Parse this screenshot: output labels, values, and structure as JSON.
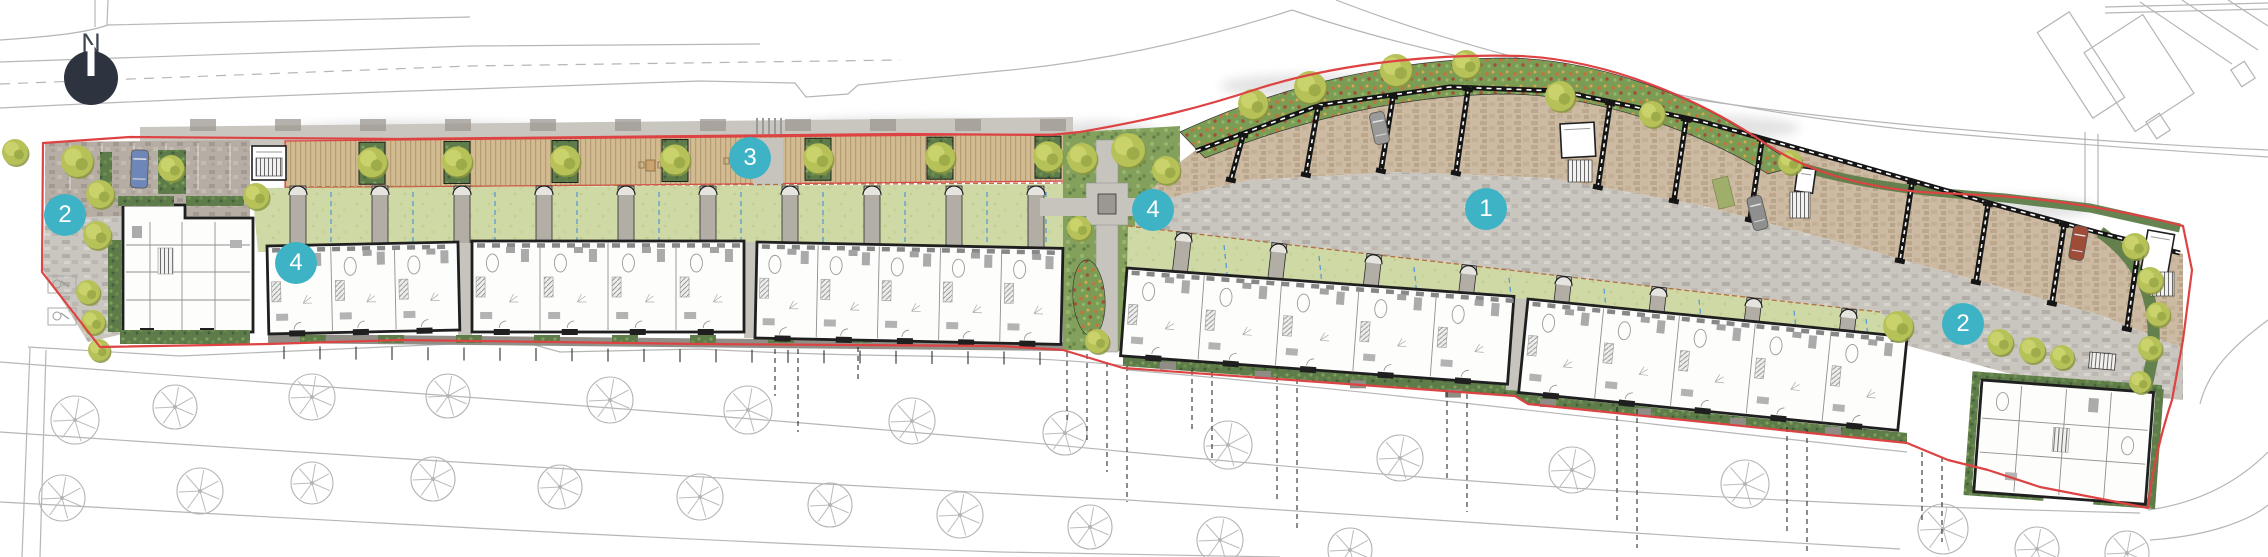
{
  "canvas": {
    "width": 2268,
    "height": 557,
    "background": "#ffffff"
  },
  "legend": {
    "north_label": "N",
    "north": {
      "x": 91,
      "y": 93,
      "r": 27,
      "circle_color": "#2e3340",
      "needle_color": "#ffffff",
      "label_color": "#3e444f"
    },
    "marker_color": "#3eb3c6",
    "marker_text_color": "#ffffff",
    "markers": [
      {
        "label": "2",
        "x": 65,
        "y": 215
      },
      {
        "label": "4",
        "x": 296,
        "y": 263
      },
      {
        "label": "3",
        "x": 750,
        "y": 158
      },
      {
        "label": "4",
        "x": 1153,
        "y": 210
      },
      {
        "label": "1",
        "x": 1486,
        "y": 209
      },
      {
        "label": "2",
        "x": 1963,
        "y": 324
      }
    ]
  },
  "palette": {
    "boundary_red": "#dd4343",
    "bg_line": "#b6b6b6",
    "leader": "#1a1a1a",
    "building_outline": "#1f1f1f",
    "interior_line": "#8f8f8f",
    "lawn": "#cfd9a5",
    "blue_dash": "#4f97d7",
    "fence_brown": "#b5713f",
    "tree_fill": "#b6c157",
    "tree_shade": "#8a9740",
    "hedge": "#5e7c49"
  },
  "background": {
    "road_lines": [
      {
        "d": "M95,0 L95,27"
      },
      {
        "d": "M108,0 L107,25"
      },
      {
        "d": "M0,40 C60,36 88,32 108,25 L470,17"
      },
      {
        "d": "M0,62 L470,46 L760,44"
      },
      {
        "d": "M0,84 L470,66 L900,60",
        "dash": "10,8"
      },
      {
        "d": "M0,108 C160,100 320,94 470,89 L700,81 L795,83 L806,97 L848,94 L858,85 L1000,71 C1100,62 1200,40 1292,10"
      },
      {
        "d": "M1292,10 C1430,58 1650,100 1900,124 C2060,139 2180,146 2268,150"
      },
      {
        "d": "M1336,0 C1470,52 1690,108 1930,132 C2080,145 2190,152 2268,157"
      },
      {
        "d": "M2105,7 L2268,3"
      },
      {
        "d": "M2105,13 L2268,9"
      },
      {
        "d": "M2085,132 L2085,209"
      },
      {
        "d": "M2098,134 L2098,212"
      },
      {
        "d": "M2140,2 L2232,64"
      },
      {
        "d": "M2182,0 L2258,50"
      },
      {
        "d": "M2228,0 L2268,26"
      },
      {
        "d": "M2268,320 C2230,348 2208,372 2200,404"
      },
      {
        "d": "M2148,510 C2205,502 2242,478 2268,452"
      },
      {
        "d": "M2150,540 C2210,536 2250,520 2268,505"
      },
      {
        "d": "M28,347 L180,356 L520,341 L560,352 L700,349 C900,360 1000,352 1128,366"
      },
      {
        "d": "M1128,370 C1390,392 1650,425 1907,452"
      },
      {
        "d": "M0,362 C380,392 760,416 1128,452 C1500,487 1800,505 2140,513"
      },
      {
        "d": "M0,432 C380,458 760,482 1128,500 C1420,520 1650,535 1900,549"
      },
      {
        "d": "M0,502 C330,520 660,540 1000,552 L1280,557"
      },
      {
        "d": "M30,348 L22,557"
      },
      {
        "d": "M46,350 L40,557"
      }
    ],
    "neighbor_buildings": [
      [
        2062,
        14,
        38,
        102,
        -33
      ],
      [
        2104,
        26,
        70,
        94,
        -33
      ],
      [
        2150,
        116,
        16,
        20,
        -33
      ],
      [
        2235,
        64,
        16,
        20,
        -33
      ]
    ],
    "street_trees_row1": [
      [
        75,
        420,
        24
      ],
      [
        175,
        407,
        22
      ],
      [
        312,
        397,
        23
      ],
      [
        448,
        396,
        22
      ],
      [
        610,
        400,
        23
      ],
      [
        748,
        410,
        24
      ],
      [
        912,
        421,
        23
      ],
      [
        1065,
        433,
        22
      ],
      [
        1228,
        445,
        24
      ],
      [
        1400,
        458,
        23
      ],
      [
        1572,
        470,
        23
      ],
      [
        1745,
        484,
        24
      ],
      [
        1943,
        529,
        25
      ],
      [
        2037,
        549,
        22
      ],
      [
        2127,
        553,
        22
      ]
    ],
    "street_trees_row2": [
      [
        62,
        498,
        23
      ],
      [
        200,
        491,
        23
      ],
      [
        312,
        483,
        21
      ],
      [
        433,
        479,
        22
      ],
      [
        560,
        487,
        22
      ],
      [
        700,
        497,
        23
      ],
      [
        830,
        505,
        22
      ],
      [
        960,
        515,
        23
      ],
      [
        1090,
        527,
        22
      ],
      [
        1220,
        540,
        23
      ],
      [
        1350,
        550,
        22
      ]
    ],
    "leader_lines": [
      [
        775,
        349,
        396
      ],
      [
        798,
        349,
        432
      ],
      [
        858,
        347,
        382
      ],
      [
        1067,
        352,
        422
      ],
      [
        1087,
        354,
        444
      ],
      [
        1107,
        362,
        472
      ],
      [
        1127,
        366,
        502
      ],
      [
        1192,
        370,
        432
      ],
      [
        1212,
        372,
        462
      ],
      [
        1277,
        377,
        502
      ],
      [
        1297,
        379,
        532
      ],
      [
        1447,
        392,
        482
      ],
      [
        1467,
        394,
        512
      ],
      [
        1617,
        407,
        522
      ],
      [
        1637,
        409,
        548
      ],
      [
        1787,
        427,
        532
      ],
      [
        1807,
        429,
        552
      ],
      [
        1922,
        452,
        522
      ],
      [
        1942,
        457,
        542
      ]
    ],
    "front_ticks": {
      "x0": 284,
      "x1": 1050,
      "step": 36,
      "len": 13,
      "yA": 346,
      "yB": 352
    }
  },
  "site": {
    "boundary_d": "M43,143 L130,137 L400,139 L700,136 L900,134 L1050,135 L1080,132 C1150,120 1200,108 1260,88 C1350,60 1450,54 1520,56 C1610,60 1700,100 1760,140 C1800,168 1850,185 1920,192 L2000,196 C2060,200 2130,212 2183,226 L2192,270 L2183,340 L2172,400 C2162,430 2152,470 2148,508 L2040,487 L1988,470 L1948,460 L1907,443 L1528,404 L1515,396 L1123,368 L1063,350 L1000,346 L700,344 L400,340 L268,344 L100,347 L42,272 Z",
    "pavement_top": [
      [
        140,
        127
      ],
      [
        1073,
        117
      ],
      [
        1073,
        141
      ],
      [
        140,
        147
      ]
    ],
    "wall_marks": {
      "x0": 190,
      "x1": 1045,
      "step": 85
    },
    "deck": {
      "x0": 285,
      "x1": 1073,
      "yTop0": 141,
      "yTop1": 134,
      "h": 47,
      "squares": [
        372,
        457,
        565,
        675,
        818,
        940,
        1048
      ],
      "furniture": [
        [
          646,
          160
        ],
        [
          731,
          156
        ]
      ],
      "crossing_x": 753
    },
    "lawn1": {
      "poly": [
        [
          252,
          188
        ],
        [
          1063,
          184
        ],
        [
          1063,
          250
        ],
        [
          258,
          252
        ]
      ],
      "dividers": [
        290,
        372,
        454,
        536,
        618,
        700,
        782,
        864,
        946,
        1028
      ],
      "blue": [
        331,
        413,
        495,
        577,
        659,
        741,
        823,
        905,
        987,
        1046
      ],
      "y_top": 186,
      "y_bot": 250
    },
    "terrace_blocks": [
      {
        "x": 267,
        "y": 246,
        "w": 191,
        "h": 88,
        "rot": -1.2,
        "units": 3
      },
      {
        "x": 472,
        "y": 241,
        "w": 272,
        "h": 91,
        "rot": 0,
        "units": 4
      },
      {
        "x": 757,
        "y": 242,
        "w": 306,
        "h": 96,
        "rot": 1.2,
        "units": 5
      },
      {
        "x": 1127,
        "y": 268,
        "w": 388,
        "h": 88,
        "rot": 4.2,
        "units": 5
      },
      {
        "x": 1528,
        "y": 299,
        "w": 381,
        "h": 94,
        "rot": 5.7,
        "units": 5
      }
    ],
    "gap_paths": [
      [
        458,
        243,
        14,
        92,
        0
      ],
      [
        744,
        242,
        13,
        96,
        0
      ],
      [
        1513,
        298,
        14,
        92,
        4.6
      ]
    ],
    "front1": [
      [
        268,
        334
      ],
      [
        1063,
        342
      ],
      [
        1063,
        351
      ],
      [
        268,
        343
      ]
    ],
    "front2": [
      [
        1123,
        356
      ],
      [
        1515,
        386
      ],
      [
        1528,
        395
      ],
      [
        1907,
        433
      ],
      [
        1907,
        443
      ],
      [
        1528,
        405
      ],
      [
        1515,
        396
      ],
      [
        1123,
        366
      ]
    ],
    "left_apartment": [
      [
        123,
        205
      ],
      [
        185,
        205
      ],
      [
        185,
        218
      ],
      [
        253,
        218
      ],
      [
        253,
        332
      ],
      [
        123,
        332
      ]
    ],
    "left_court": [
      [
        45,
        142
      ],
      [
        250,
        140
      ],
      [
        250,
        218
      ],
      [
        160,
        222
      ],
      [
        45,
        218
      ]
    ],
    "left_lower": [
      [
        45,
        218
      ],
      [
        123,
        216
      ],
      [
        123,
        334
      ],
      [
        88,
        342
      ],
      [
        43,
        270
      ]
    ],
    "left_planting": [
      [
        100,
        152,
        12,
        52
      ],
      [
        118,
        196,
        56,
        10
      ],
      [
        186,
        196,
        58,
        10
      ],
      [
        108,
        240,
        14,
        92
      ],
      [
        120,
        330,
        130,
        14
      ],
      [
        158,
        150,
        28,
        44
      ]
    ],
    "moto_bays": [
      [
        48,
        276,
        28,
        17
      ],
      [
        48,
        308,
        28,
        17
      ]
    ],
    "walkway": {
      "base": [
        [
          1063,
          133
        ],
        [
          1180,
          126
        ],
        [
          1180,
          352
        ],
        [
          1063,
          350
        ]
      ],
      "path": [
        1096,
        140,
        22,
        212
      ],
      "plaza": [
        1086,
        183,
        42,
        42
      ],
      "feature": [
        1098,
        194,
        18,
        20
      ],
      "arm": [
        1040,
        198,
        140,
        18
      ],
      "teardrop": [
        1089,
        298,
        16,
        38
      ]
    },
    "courts_top": [
      [
        1180,
        162
      ],
      [
        1196,
        150
      ],
      [
        1320,
        104
      ],
      [
        1450,
        86
      ],
      [
        1560,
        90
      ],
      [
        1700,
        120
      ],
      [
        1850,
        162
      ],
      [
        2000,
        205
      ],
      [
        2100,
        232
      ],
      [
        2183,
        254
      ]
    ],
    "courts_bot": [
      [
        1135,
        205
      ],
      [
        1250,
        180
      ],
      [
        1400,
        172
      ],
      [
        1550,
        178
      ],
      [
        1700,
        205
      ],
      [
        1850,
        245
      ],
      [
        2000,
        287
      ],
      [
        2100,
        315
      ],
      [
        2183,
        348
      ]
    ],
    "street_bot": [
      [
        1135,
        228
      ],
      [
        1300,
        246
      ],
      [
        1500,
        269
      ],
      [
        1700,
        292
      ],
      [
        1880,
        312
      ],
      [
        1905,
        345
      ],
      [
        1960,
        360
      ],
      [
        2040,
        382
      ],
      [
        2160,
        398
      ],
      [
        2183,
        400
      ]
    ],
    "lawn2": {
      "poly": [
        [
          1128,
          226
        ],
        [
          1300,
          246
        ],
        [
          1500,
          269
        ],
        [
          1700,
          292
        ],
        [
          1880,
          312
        ],
        [
          1907,
          338
        ],
        [
          1528,
          299
        ],
        [
          1515,
          300
        ],
        [
          1127,
          268
        ]
      ],
      "dividers": [
        1177,
        1272,
        1367,
        1462,
        1557,
        1652,
        1747,
        1842
      ],
      "blue": [
        1224,
        1319,
        1414,
        1509,
        1604,
        1699,
        1794,
        1866
      ],
      "top_y0": 226,
      "slope": 0.115,
      "x_ref": 1128,
      "depth": 46
    },
    "ornamental_bed_d": "M1180,132 C1280,85 1400,58 1510,58 C1600,60 1690,96 1745,132 L1798,166 L1768,174 C1700,132 1600,96 1510,94 C1405,94 1300,120 1205,158 Z",
    "hedge_top_d": "M1798,166 C1870,188 1940,193 2005,198 L2090,208 L2180,228",
    "carports": [
      1243,
      1318,
      1393,
      1468,
      1610,
      1686,
      1762,
      1912,
      1988,
      2064,
      2139
    ],
    "stores": [
      {
        "x": 252,
        "y": 146,
        "w": 34,
        "h": 34,
        "rot": 0,
        "pad": [
          256,
          158,
          26,
          18
        ]
      },
      {
        "x": 1560,
        "y": 124,
        "w": 34,
        "h": 34,
        "rot": -3,
        "pad": [
          1568,
          160,
          24,
          22
        ]
      },
      {
        "x": 1798,
        "y": 167,
        "w": 18,
        "h": 24,
        "rot": 8,
        "pad": [
          1790,
          192,
          20,
          26
        ]
      },
      {
        "x": 2148,
        "y": 230,
        "w": 27,
        "h": 40,
        "rot": 10,
        "pad": [
          2150,
          272,
          24,
          24
        ]
      }
    ],
    "right_apartment": {
      "x": 1982,
      "y": 380,
      "w": 172,
      "h": 112,
      "rot": 4.2
    },
    "cars": [
      {
        "x": 131,
        "y": 150,
        "w": 17,
        "l": 38,
        "rot": 2,
        "color": "#6f87b8"
      },
      {
        "x": 1372,
        "y": 112,
        "w": 15,
        "l": 32,
        "rot": -12,
        "color": "#9a9a98"
      },
      {
        "x": 1750,
        "y": 196,
        "w": 15,
        "l": 34,
        "rot": -14,
        "color": "#8f8f8f"
      },
      {
        "x": 2071,
        "y": 226,
        "w": 15,
        "l": 34,
        "rot": 10,
        "color": "#9e4b38"
      }
    ],
    "grass_bay": [
      1712,
      180,
      16,
      30,
      -14
    ],
    "trees": [
      [
        15,
        152,
        13
      ],
      [
        77,
        161,
        16
      ],
      [
        100,
        194,
        14
      ],
      [
        97,
        235,
        14
      ],
      [
        88,
        292,
        12
      ],
      [
        93,
        322,
        12
      ],
      [
        99,
        350,
        11
      ],
      [
        171,
        168,
        13
      ],
      [
        256,
        196,
        13
      ],
      [
        1082,
        158,
        15
      ],
      [
        1128,
        150,
        17
      ],
      [
        1166,
        170,
        14
      ],
      [
        1079,
        228,
        12
      ],
      [
        1097,
        341,
        12
      ],
      [
        1253,
        104,
        15
      ],
      [
        1310,
        87,
        16
      ],
      [
        1396,
        70,
        16
      ],
      [
        1466,
        64,
        14
      ],
      [
        1560,
        96,
        15
      ],
      [
        1652,
        114,
        13
      ],
      [
        1790,
        162,
        12
      ],
      [
        1898,
        326,
        15
      ],
      [
        2000,
        342,
        13
      ],
      [
        2032,
        350,
        13
      ],
      [
        2062,
        357,
        12
      ],
      [
        2135,
        246,
        13
      ],
      [
        2150,
        280,
        13
      ],
      [
        2158,
        314,
        12
      ],
      [
        2150,
        348,
        12
      ],
      [
        2140,
        382,
        11
      ]
    ],
    "shadows": [
      [
        420,
        133,
        140,
        12
      ],
      [
        900,
        128,
        120,
        11
      ],
      [
        1310,
        86,
        90,
        12
      ],
      [
        1700,
        128,
        100,
        13
      ],
      [
        2005,
        208,
        90,
        12
      ],
      [
        160,
        200,
        60,
        14
      ],
      [
        1100,
        135,
        60,
        14
      ]
    ]
  }
}
